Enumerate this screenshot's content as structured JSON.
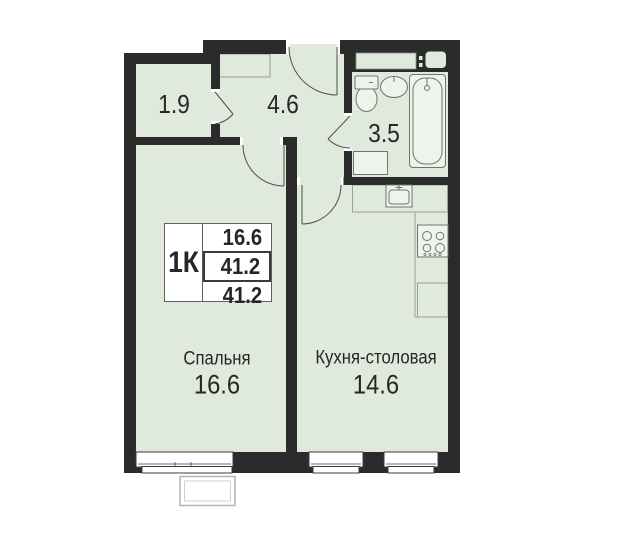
{
  "apartment": {
    "legend": {
      "type_label": "1К",
      "values": [
        "16.6",
        "41.2",
        "41.2"
      ]
    },
    "rooms": {
      "wardrobe": {
        "area": "1.9"
      },
      "hallway": {
        "area": "4.6"
      },
      "bathroom": {
        "area": "3.5"
      },
      "bedroom": {
        "name": "Спальня",
        "area": "16.6"
      },
      "kitchen": {
        "name": "Кухня-столовая",
        "area": "14.6"
      }
    },
    "icons": {
      "toilet": "toilet-icon",
      "bathroom_sink": "sink-icon",
      "bathtub": "bathtub-icon",
      "washing_machine": "washing-machine-icon",
      "kitchen_sink": "kitchen-sink-icon",
      "stove": "stove-icon",
      "wardrobe_closet": "wardrobe-icon",
      "entrance_door": "entrance-door-icon",
      "interior_door": "door-arc-icon",
      "window": "window-icon",
      "balcony": "balcony-icon",
      "vent_shaft": "vent-shaft-icon"
    },
    "colors": {
      "floor": "#dfe9dc",
      "wall": "#2b2b2b",
      "fixture_line": "#6f756f",
      "counter_line": "#98a098",
      "text": "#262626"
    }
  }
}
